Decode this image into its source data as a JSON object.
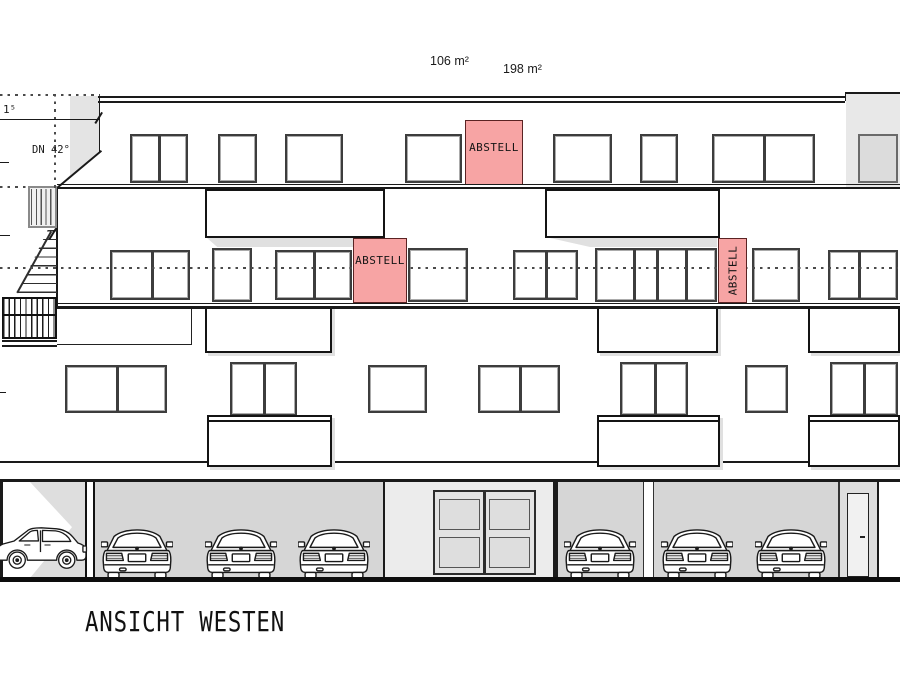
{
  "drawing": {
    "title": "ANSICHT WESTEN",
    "area_labels": [
      {
        "text": "106 m²"
      },
      {
        "text": "198 m²"
      }
    ],
    "roof_pitch_label": "DN 42°",
    "dimension_label": "1⁵",
    "storage_rooms": [
      {
        "label": "ABSTELL"
      },
      {
        "label": "ABSTELL"
      },
      {
        "label": "ABSTELL"
      }
    ],
    "colors": {
      "storage_fill": "#f7a4a4",
      "roof_shade": "#e4e4e4",
      "garage_fill": "#d6d6d6",
      "line": "#1a1a1a"
    }
  }
}
